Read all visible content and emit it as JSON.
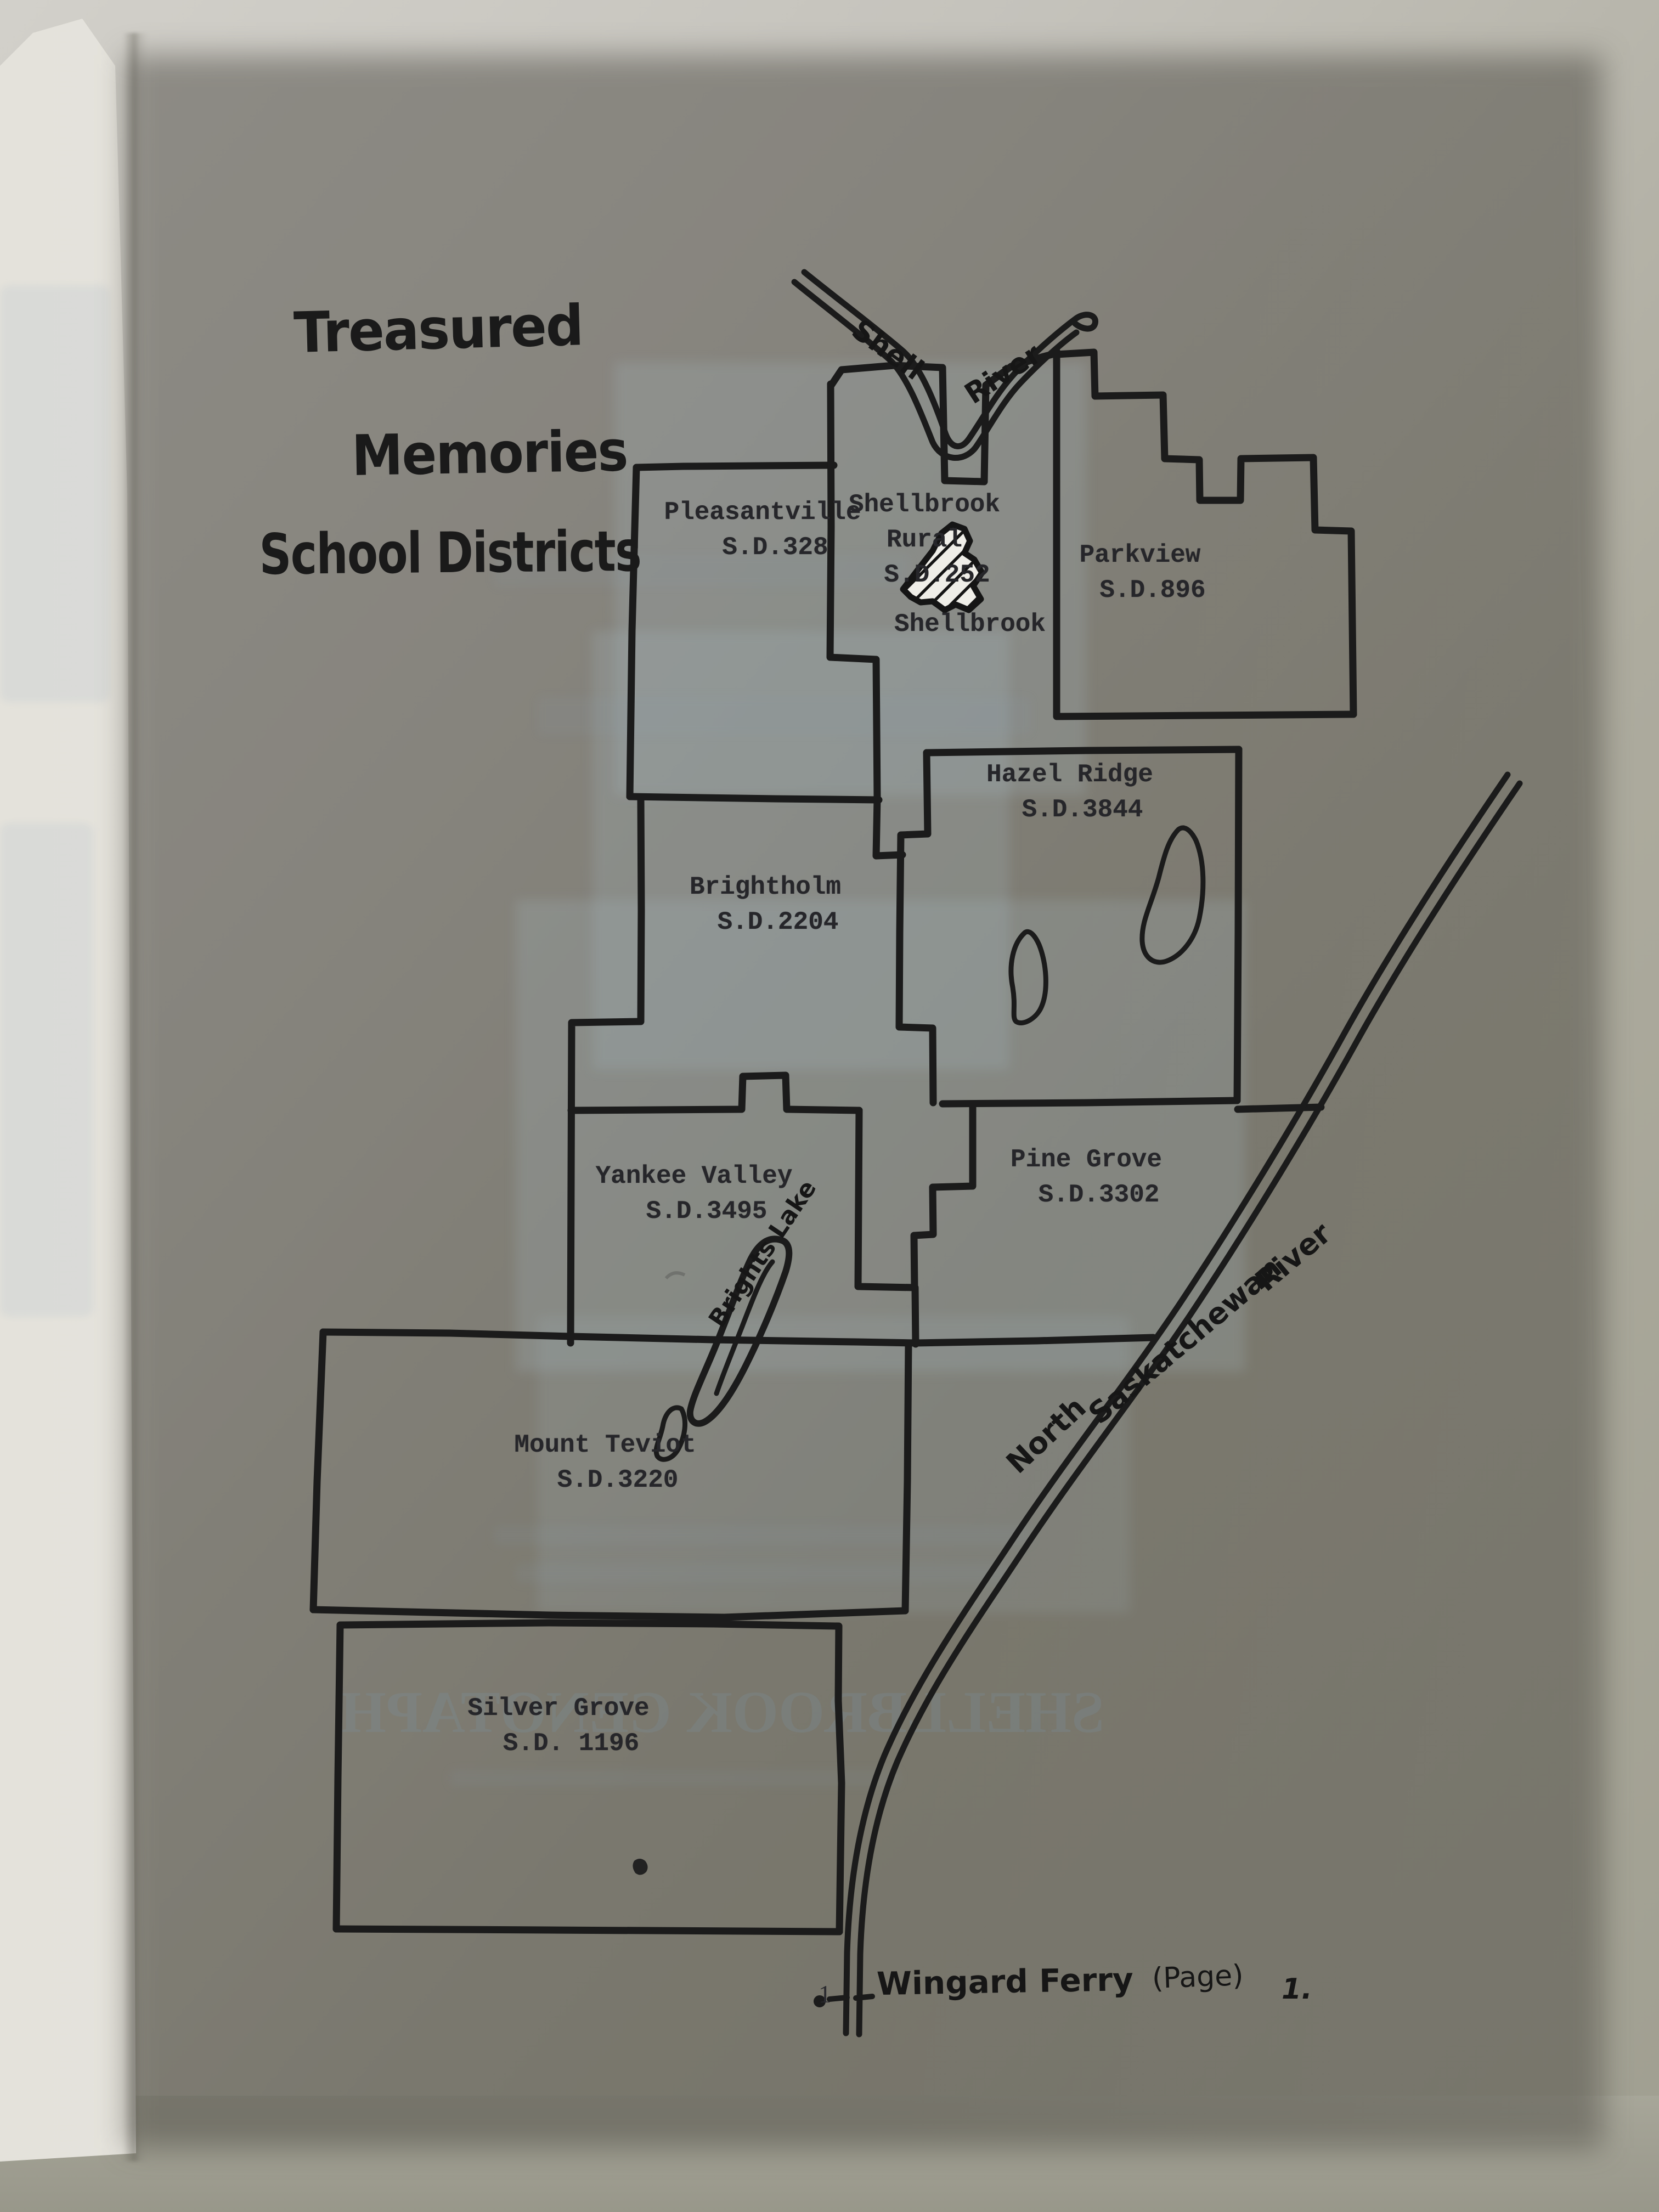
{
  "page": {
    "title_lines": [
      "Treasured",
      "Memories",
      "School Districts"
    ],
    "page_number": "1"
  },
  "map": {
    "districts": [
      {
        "name": "Shellbrook Rural",
        "sd": "S.D.252"
      },
      {
        "name": "Parkview",
        "sd": "S.D.896"
      },
      {
        "name": "Pleasantville",
        "sd": "S.D.328"
      },
      {
        "name": "Hazel Ridge",
        "sd": "S.D.3844"
      },
      {
        "name": "Brightholm",
        "sd": "S.D.2204"
      },
      {
        "name": "Pine Grove",
        "sd": "S.D.3302"
      },
      {
        "name": "Yankee Valley",
        "sd": "S.D.3495"
      },
      {
        "name": "Mount Teviot",
        "sd": "S.D.3220"
      },
      {
        "name": "Silver Grove",
        "sd": "S.D. 1196"
      }
    ],
    "towns": [
      {
        "name": "Shellbrook"
      }
    ],
    "lakes": [
      {
        "name": "Brights Lake"
      }
    ],
    "rivers": [
      {
        "name": "Shell River",
        "label_parts": [
          "Shell",
          "River"
        ]
      },
      {
        "name": "North Saskatchewan River",
        "label_parts": [
          "North",
          "Saskatchewan",
          "River"
        ]
      }
    ],
    "ferry": {
      "label": "Wingard Ferry",
      "page_ref": "(Page)",
      "page_ref_number": "1."
    }
  },
  "showthrough": {
    "headline": "SHELLBROOK CENOTAPH"
  },
  "colors": {
    "ink": "#1b1b1b",
    "paper": "#edece6",
    "wall": "#adab9e",
    "bleed_blue": "#a8bECA"
  }
}
